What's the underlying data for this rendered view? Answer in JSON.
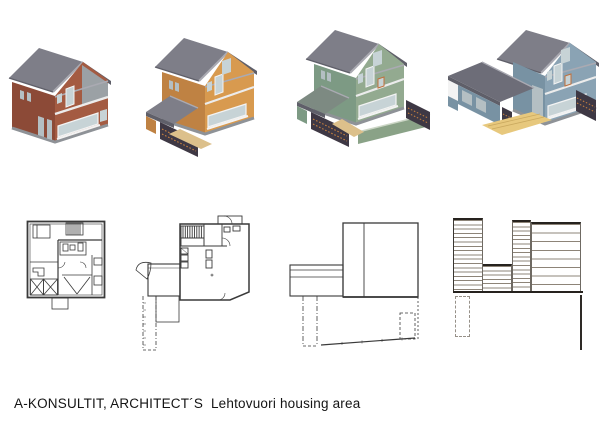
{
  "caption": "A-KONSULTIT, ARCHITECT´S  Lehtovuori housing area",
  "figures": {
    "renderings": [
      {
        "name": "axonometric-rendering-red-house"
      },
      {
        "name": "axonometric-rendering-orange-house"
      },
      {
        "name": "axonometric-rendering-green-house"
      },
      {
        "name": "axonometric-rendering-blue-house"
      }
    ],
    "plans": [
      {
        "name": "floor-plan-1"
      },
      {
        "name": "floor-plan-2-with-ramp"
      },
      {
        "name": "roof-plan-3"
      },
      {
        "name": "deck-plan-4"
      }
    ]
  },
  "theme": {
    "css_vars": {
      "--roof": "#7e7e88",
      "--roof-dark": "#5f5f69",
      "--roof-edge": "#aaaab2",
      "--win": "#c7d3d6",
      "--win-dim": "#b4bfc3",
      "--frame": "#f3f3f3",
      "--plinth": "#8e9297",
      "--band": "#ececec",
      "--h1-wall-lit": "#a45b42",
      "--h1-wall-sh": "#8c4a37",
      "--h1-panel": "#9ba1a5",
      "--h2-wall-lit": "#d89a4f",
      "--h2-wall-sh": "#bf8243",
      "--h3-wall-lit": "#93aa90",
      "--h3-wall-sh": "#7d9a84",
      "--h3-fence": "#8aa287",
      "--h3-fence-top": "#ccd6c6",
      "--h3-porch-roof": "#7d8a82",
      "--h4-wall-lit": "#8aa3b4",
      "--h4-wall-sh": "#7892a3",
      "--h4-deck": "#e7c87d",
      "--h4-white": "#f3f3f3",
      "--h4-wing-roof": "#6d6d78",
      "--walkway": "#dcc08b",
      "--trellis": "#3e3844",
      "--trellis-dot": "#c8813f",
      "--accent-orange": "#c0703c",
      "--plan-line": "#3a3a3a",
      "--hatch": "#8d8478"
    }
  }
}
